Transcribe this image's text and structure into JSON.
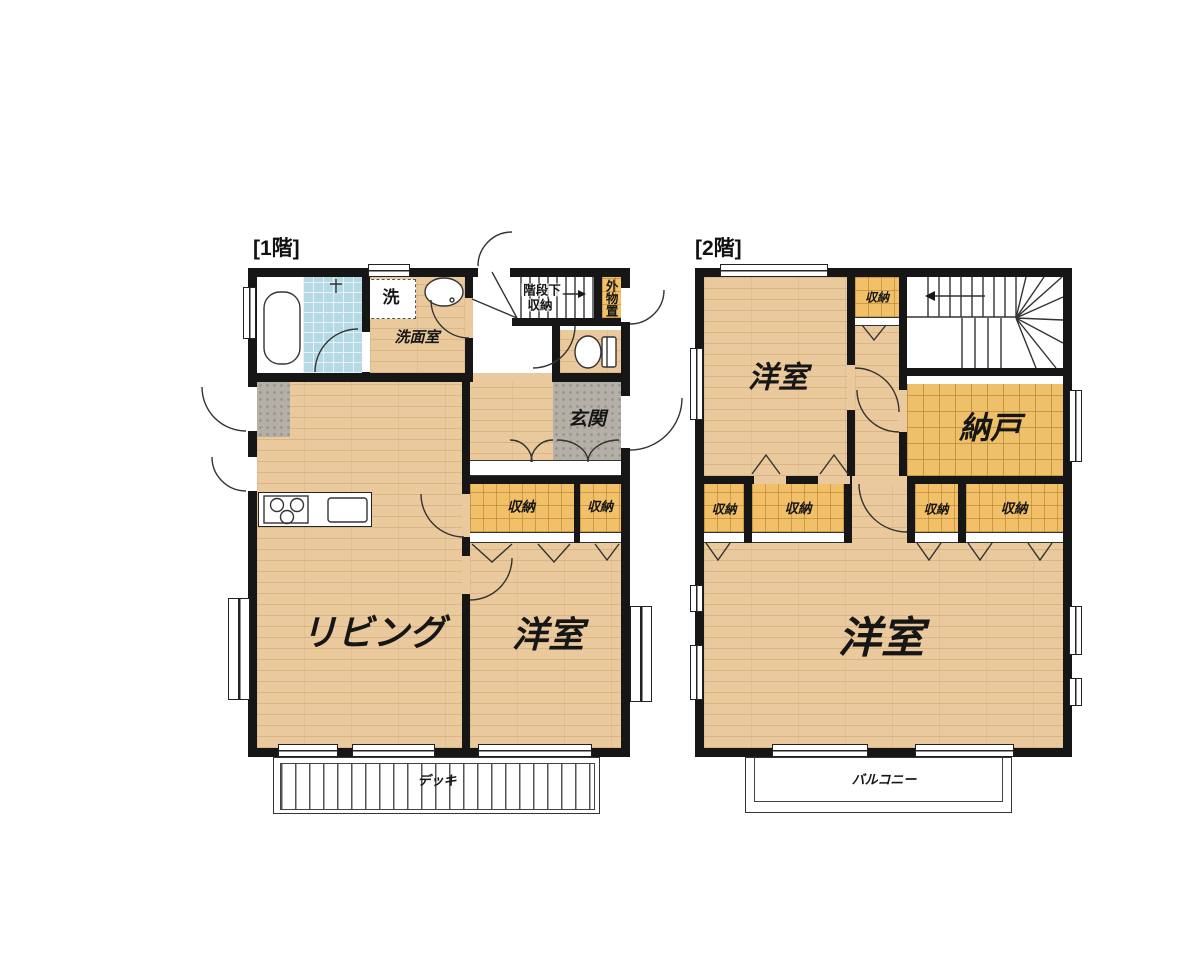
{
  "floor1": {
    "title": "[1階]",
    "living": "リビング",
    "bedroom": "洋室",
    "washroom": "洗面室",
    "washer": "洗",
    "under_stair_storage_line1": "階段下",
    "under_stair_storage_line2": "収納",
    "outdoor_storage": "外物置",
    "entrance": "玄関",
    "storage": "収納",
    "deck": "デッキ"
  },
  "floor2": {
    "title": "[2階]",
    "bedroom": "洋室",
    "storage": "収納",
    "storeroom": "納戸",
    "balcony": "バルコニー"
  },
  "colors": {
    "wall": "#161616",
    "wood_floor": "#eac99d",
    "tatami_closet": "#f1c068",
    "entrance_stone": "#b5b0a7",
    "bath_tile": "#b5dae6"
  }
}
